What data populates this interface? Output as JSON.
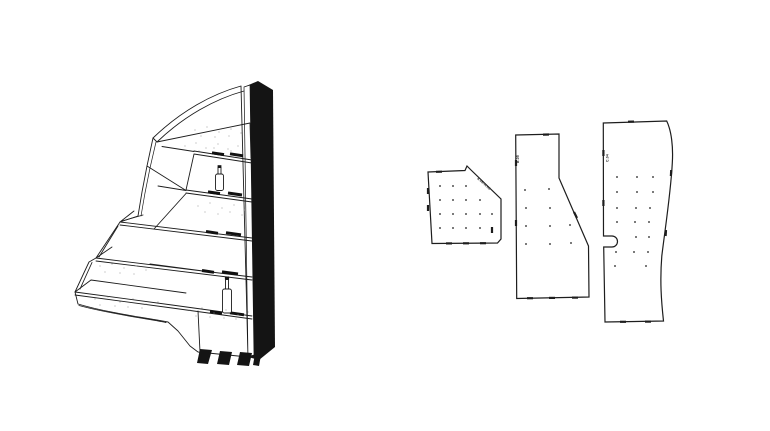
{
  "canvas": {
    "width": 770,
    "height": 431,
    "background": "#ffffff",
    "ink": "#1d1d1d"
  },
  "assembly_view": {
    "name": "shelf-assembly-3d-line-view",
    "shelf_count": 5,
    "bottle_count": 2,
    "foot_count": 3
  },
  "flat_patterns": {
    "hole_color": "#1d1d1d",
    "panels": [
      {
        "id": "panel-a",
        "label": "6.06-A.06",
        "label_x": 477,
        "label_y": 179,
        "label_rotate": 42,
        "outline": "M428,172 L465,170.5 L467,166 L471,170 L501,199 L501,239 L497.5,243 L432,243.5 Z",
        "holes": [
          [
            440,
            186
          ],
          [
            453,
            186
          ],
          [
            466,
            186
          ],
          [
            440,
            200
          ],
          [
            453,
            200
          ],
          [
            466,
            200
          ],
          [
            480,
            200
          ],
          [
            440,
            214
          ],
          [
            453,
            214
          ],
          [
            466,
            214
          ],
          [
            480,
            214
          ],
          [
            492,
            214
          ],
          [
            440,
            228
          ],
          [
            453,
            228
          ],
          [
            466,
            228
          ],
          [
            480,
            228
          ],
          [
            492,
            228
          ]
        ],
        "ticks": [
          [
            446,
            243.4,
            452,
            243.4
          ],
          [
            463,
            243.3,
            469,
            243.3
          ],
          [
            480,
            243.2,
            486,
            243.2
          ],
          [
            428,
            205,
            428,
            211
          ],
          [
            428,
            188,
            428,
            194
          ],
          [
            436,
            171.8,
            442,
            171.7
          ],
          [
            492,
            227,
            492,
            233
          ]
        ]
      },
      {
        "id": "panel-b",
        "label": "B.05",
        "label_x": 519,
        "label_y": 163,
        "label_rotate": -90,
        "outline": "M515.7,135 L559,134 L559,178 L588.5,246 L589,297 L516.7,298.5 Z",
        "holes": [
          [
            525,
            190
          ],
          [
            549,
            189
          ],
          [
            526,
            208
          ],
          [
            550,
            208
          ],
          [
            526,
            226
          ],
          [
            550,
            226
          ],
          [
            570,
            225
          ],
          [
            526,
            244
          ],
          [
            550,
            244
          ],
          [
            571,
            243
          ]
        ],
        "ticks": [
          [
            543,
            134.6,
            549,
            134.5
          ],
          [
            527,
            298.2,
            533,
            298.2
          ],
          [
            549,
            297.9,
            555,
            297.9
          ],
          [
            572,
            297.6,
            578,
            297.6
          ],
          [
            516,
            160,
            516,
            166
          ],
          [
            516,
            220,
            516,
            226
          ],
          [
            574,
            212,
            577,
            218
          ]
        ]
      },
      {
        "id": "panel-c",
        "label": "C.04",
        "label_x": 608.5,
        "label_y": 162,
        "label_rotate": -90,
        "outline": "M603.3,123 L666.7,121 C671.5,131 673.3,147 672.3,163 C670.8,192 665.5,226 661.8,256 C659.8,281 661.3,301 663.5,321 L605,322 L603.7,247 L612,247 A5.5,5.5 0 0 0 612,236 L603.5,236 Z",
        "holes": [
          [
            617,
            177
          ],
          [
            637,
            177
          ],
          [
            653,
            177
          ],
          [
            617,
            192
          ],
          [
            637,
            192
          ],
          [
            653,
            192
          ],
          [
            617,
            208
          ],
          [
            636,
            208
          ],
          [
            650,
            208
          ],
          [
            617,
            222
          ],
          [
            635,
            222
          ],
          [
            649,
            222
          ],
          [
            636,
            237
          ],
          [
            649,
            237
          ],
          [
            616,
            252
          ],
          [
            634,
            252
          ],
          [
            648,
            252
          ],
          [
            615,
            266
          ],
          [
            646,
            266
          ]
        ],
        "ticks": [
          [
            603.4,
            150,
            603.4,
            156
          ],
          [
            603.4,
            200,
            603.4,
            206
          ],
          [
            671.2,
            170,
            670.9,
            176
          ],
          [
            666,
            230,
            665.6,
            236
          ],
          [
            620,
            321.8,
            626,
            321.8
          ],
          [
            645,
            321.6,
            651,
            321.6
          ],
          [
            628,
            121.7,
            634,
            121.6
          ]
        ]
      }
    ]
  }
}
